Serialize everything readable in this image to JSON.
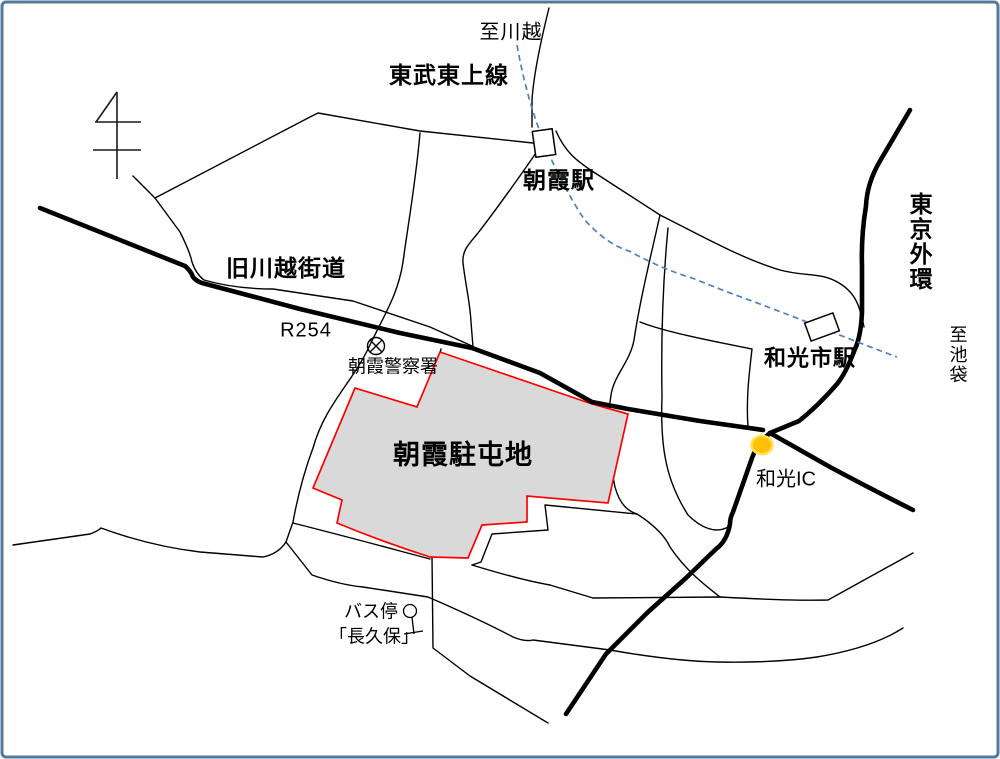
{
  "map": {
    "title": "朝霞駐屯地 案内図",
    "labels": {
      "to_kawagoe": "至川越",
      "tobu_tojo_line": "東武東上線",
      "asaka_station": "朝霞駅",
      "kyu_kawagoe_kaido": "旧川越街道",
      "route_254": "R254",
      "asaka_police": "朝霞警察署",
      "camp_asaka": "朝霞駐屯地",
      "wakoshi_station": "和光市駅",
      "tokyo_gaikan": "東京外環",
      "to_ikebukuro": "至池袋",
      "wako_ic": "和光IC",
      "bus_stop": "バス停",
      "bus_stop_name": "「長久保」"
    },
    "colors": {
      "camp_fill": "#d9d9d9",
      "camp_border": "#ff0000",
      "railway": "#4f81bd",
      "road": "#000000",
      "ic_dot_fill": "#ffc107",
      "ic_dot_rim": "#ffe14d",
      "frame": "#54779e"
    }
  }
}
